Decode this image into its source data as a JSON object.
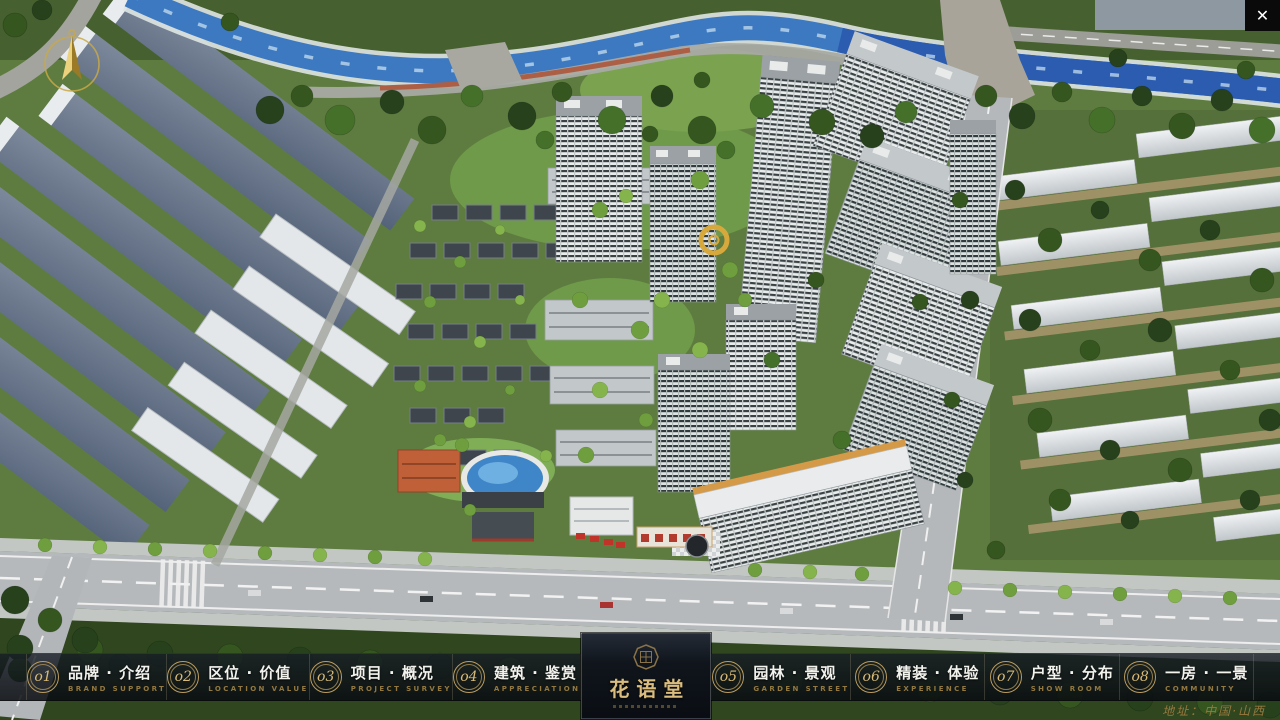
{
  "icons": {
    "close": "✕"
  },
  "navbar": {
    "items": [
      {
        "num": "o1",
        "zh": "品牌 · 介绍",
        "en": "BRAND SUPPORT"
      },
      {
        "num": "o2",
        "zh": "区位 · 价值",
        "en": "LOCATION VALUE"
      },
      {
        "num": "o3",
        "zh": "项目 · 概况",
        "en": "PROJECT SURVEY"
      },
      {
        "num": "o4",
        "zh": "建筑 · 鉴赏",
        "en": "APPRECIATION"
      },
      {
        "num": "o5",
        "zh": "园林 · 景观",
        "en": "GARDEN STREET"
      },
      {
        "num": "o6",
        "zh": "精装 · 体验",
        "en": "EXPERIENCE"
      },
      {
        "num": "o7",
        "zh": "户型 · 分布",
        "en": "SHOW ROOM"
      },
      {
        "num": "o8",
        "zh": "一房 · 一景",
        "en": "COMMUNITY"
      }
    ],
    "logo": {
      "title": "花语堂"
    },
    "address": "地址：中国·山西"
  },
  "scene_colors": {
    "river": "#3d79c0",
    "grass": "#5e7c40",
    "road": "#b5b9bb",
    "tower_facade": "#e9ecec",
    "gold_accent": "#c5a059"
  }
}
